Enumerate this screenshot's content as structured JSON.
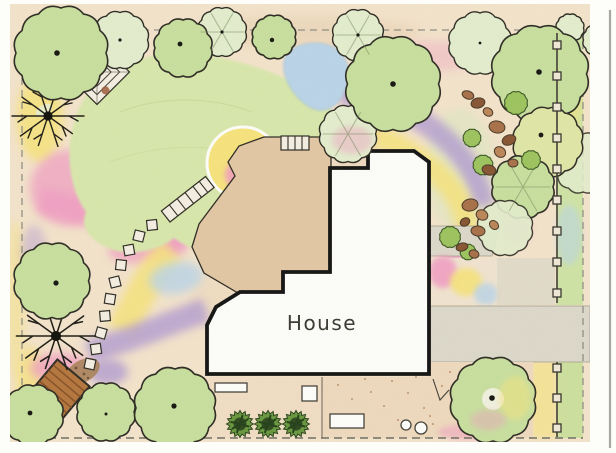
{
  "plan": {
    "house_label": "House"
  },
  "features": [
    "lawn",
    "flower-beds",
    "pond",
    "patio",
    "stepping-stone-path",
    "garden-steps",
    "gazebo-trellis",
    "arbor-bench",
    "deciduous-tree-symbols",
    "bare-branch-tree-symbols",
    "evergreen-shrubs",
    "boulders",
    "fence-with-posts",
    "driveway",
    "walkway",
    "stippled-patio",
    "planters",
    "flower-pots",
    "property-line"
  ],
  "palette": {
    "paper": "#fdfdfa",
    "scan_line": "#a8a8a2",
    "ground": "#f3e3cb",
    "ground_deep": "#e9d2b4",
    "lawn": "#d8e7ac",
    "lawn_line": "#c2d793",
    "tree_green": "#c8df9f",
    "tree_pale": "#e3edcd",
    "tree_yellow": "#dfe6a6",
    "shrub_bright": "#9dc45f",
    "shrub_mid": "#699840",
    "shrub_dark": "#2f4a1e",
    "yellow": "#f6e37d",
    "pink": "#f09cc2",
    "purple": "#b29cd1",
    "lavender": "#c9b6e0",
    "water": "#bad4e8",
    "patio": "#e2c7a4",
    "walk": "#dcd8ca",
    "stone": "#f3eee1",
    "rock": "#a8714a",
    "rock_dark": "#875634",
    "rock_light": "#bb8659",
    "gravel": "#a8835a",
    "outline": "#2e2c24",
    "house_fill": "#fdfdfa",
    "house_outline": "#141414",
    "fence_post": "#efe8d6",
    "dash": "#8f8f85",
    "dash_dark": "#6e6e64",
    "label": "#3a3a33",
    "dot": "#171712"
  }
}
